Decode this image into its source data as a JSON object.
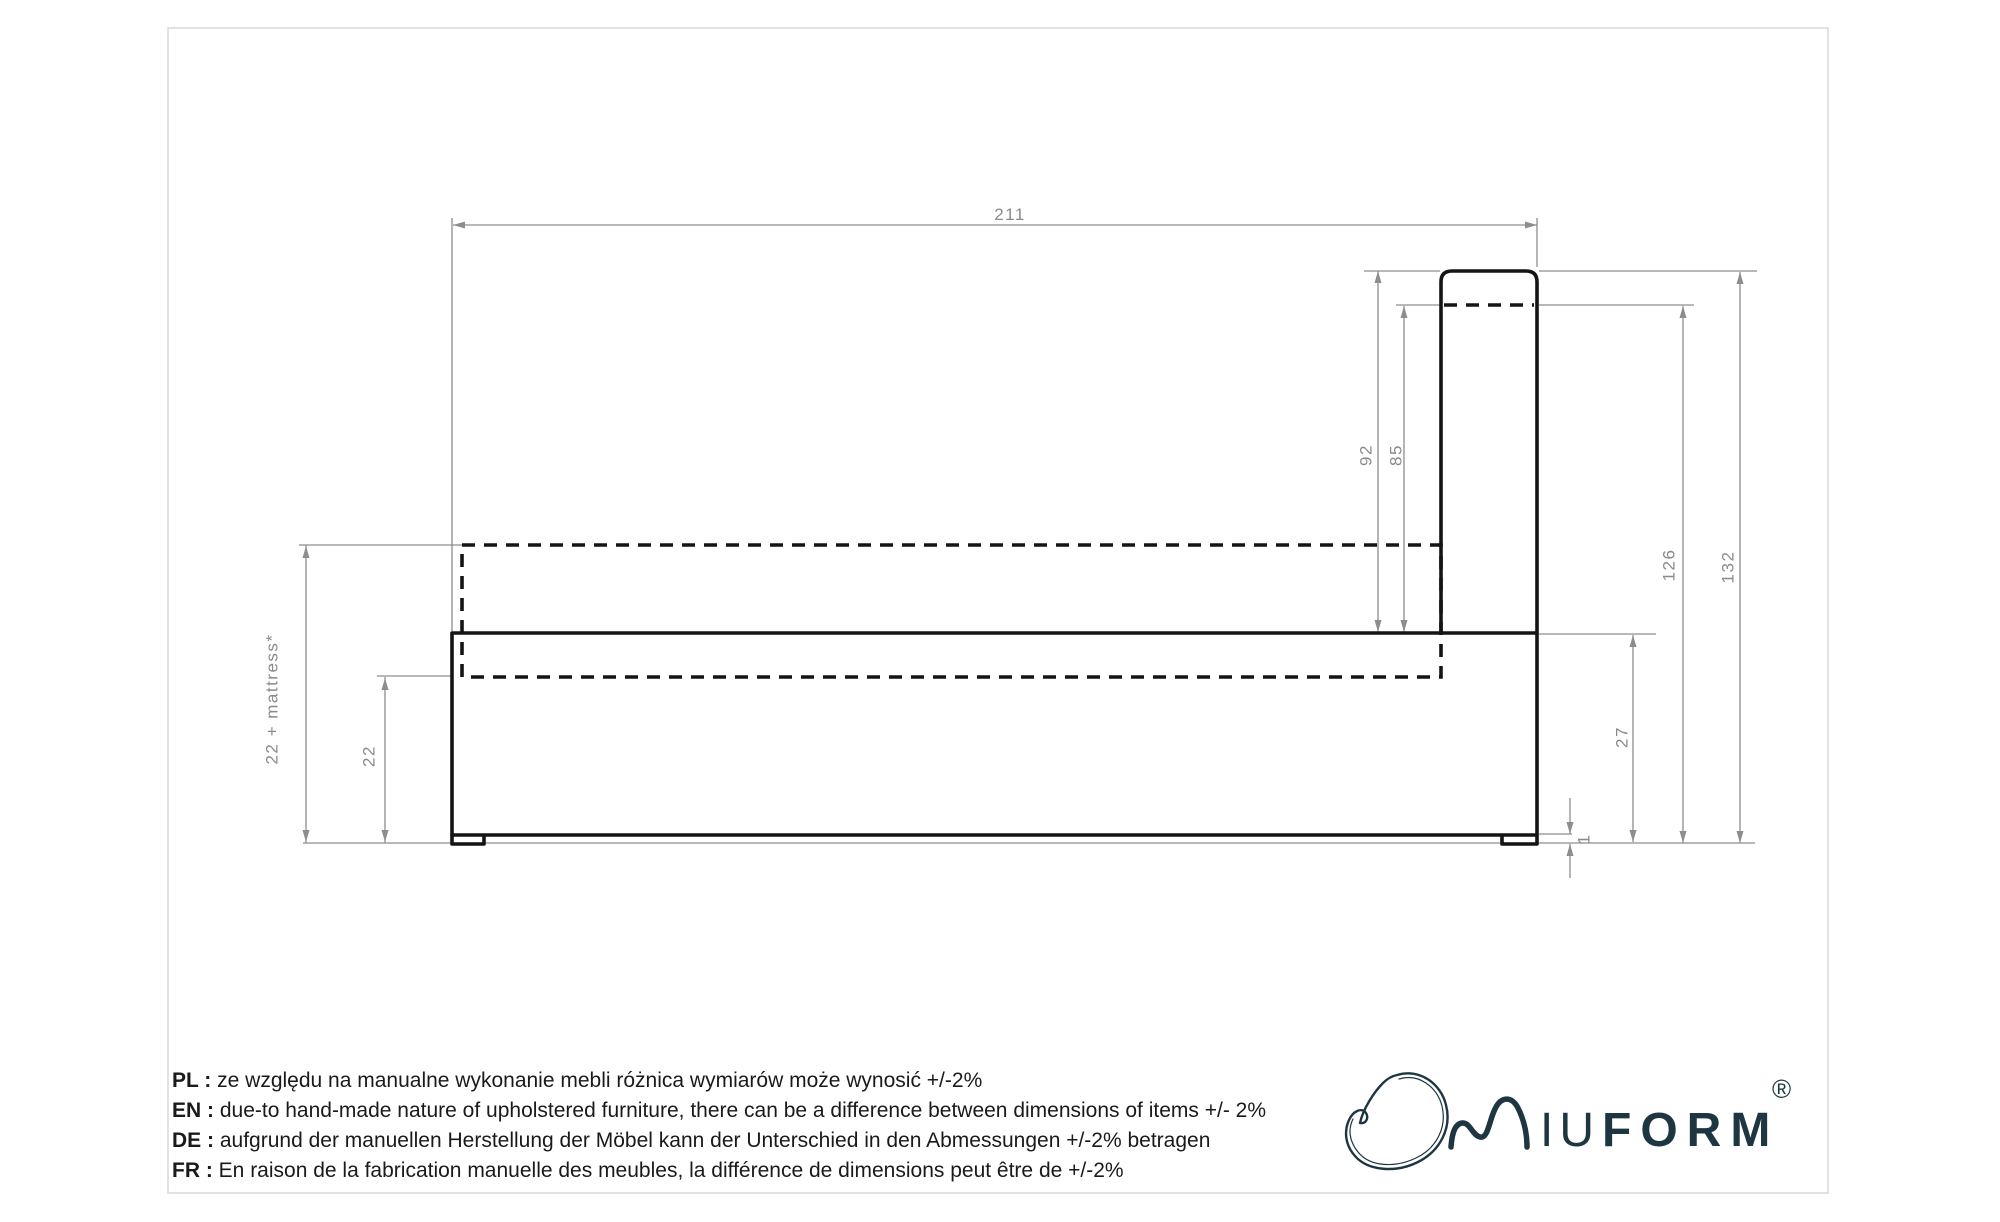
{
  "page": {
    "background": "#ffffff",
    "border_color": "#d8d8d8"
  },
  "colors": {
    "outline_black": "#141414",
    "dimension_gray": "#8d8d8d",
    "brand_navy": "#1e3642"
  },
  "drawing": {
    "type": "bed-side-elevation-technical-drawing",
    "dimensions": {
      "total_length": "211",
      "headboard_height_from_frame_top": "92",
      "headboard_upper_from_dashed": "85",
      "overall_height": "132",
      "height_to_headboard_dashed": "126",
      "frame_rim_to_floor": "27",
      "base_platform_height": "22",
      "base_plus_mattress": "22 + mattress*",
      "leg_height": "1"
    }
  },
  "notes": [
    {
      "label": "PL :",
      "text": "ze względu na manualne wykonanie mebli różnica wymiarów może wynosić +/-2%"
    },
    {
      "label": "EN :",
      "text": "due-to hand-made nature of upholstered furniture, there can be a difference between dimensions of items +/- 2%"
    },
    {
      "label": "DE :",
      "text": "aufgrund der manuellen Herstellung der Möbel kann der Unterschied in den Abmessungen +/-2% betragen"
    },
    {
      "label": "FR :",
      "text": "En raison de la fabrication manuelle des meubles, la différence de dimensions peut être de +/-2%"
    }
  ],
  "logo": {
    "name": "MIUFORM",
    "wordmark_thin": "IU",
    "wordmark_bold": "FORM",
    "registered": "®"
  }
}
